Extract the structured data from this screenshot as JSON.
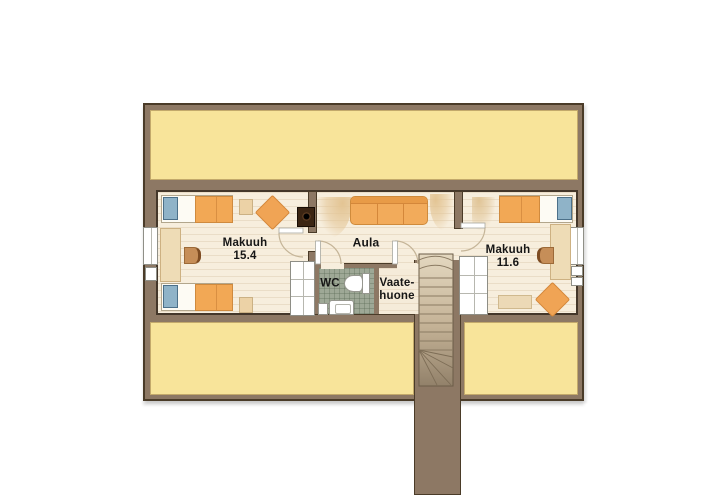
{
  "plan": {
    "type": "upper-floor-plan",
    "rooms": {
      "bedroom_left": {
        "label": "Makuuh",
        "area": "15.4"
      },
      "hall": {
        "label": "Aula"
      },
      "wc": {
        "label": "WC"
      },
      "wardrobe": {
        "label_line1": "Vaate-",
        "label_line2": "huone"
      },
      "bedroom_right": {
        "label": "Makuuh",
        "area": "11.6"
      }
    },
    "furniture": [
      "single-bed",
      "single-bed",
      "single-bed",
      "sofa-three-seat",
      "fireplace-stove",
      "desk",
      "desk",
      "chair",
      "chair",
      "side-table",
      "side-table",
      "diamond-lounge-chair",
      "diamond-lounge-chair",
      "bench",
      "toilet",
      "sink-vanity",
      "closet",
      "closet",
      "staircase-with-winders",
      "window",
      "window"
    ],
    "colors": {
      "wall_fill": "#8d7864",
      "wall_outline": "#4a3b28",
      "attic_yellow": "#f8e49a",
      "floor_cream": "#f7eedd",
      "wc_tile_green_gray": "#9ea896",
      "furniture_orange": "#f2a855",
      "pillow_blue": "#8fb3c8",
      "stair_tread": "#c9b89e",
      "label_text": "#161616"
    }
  }
}
